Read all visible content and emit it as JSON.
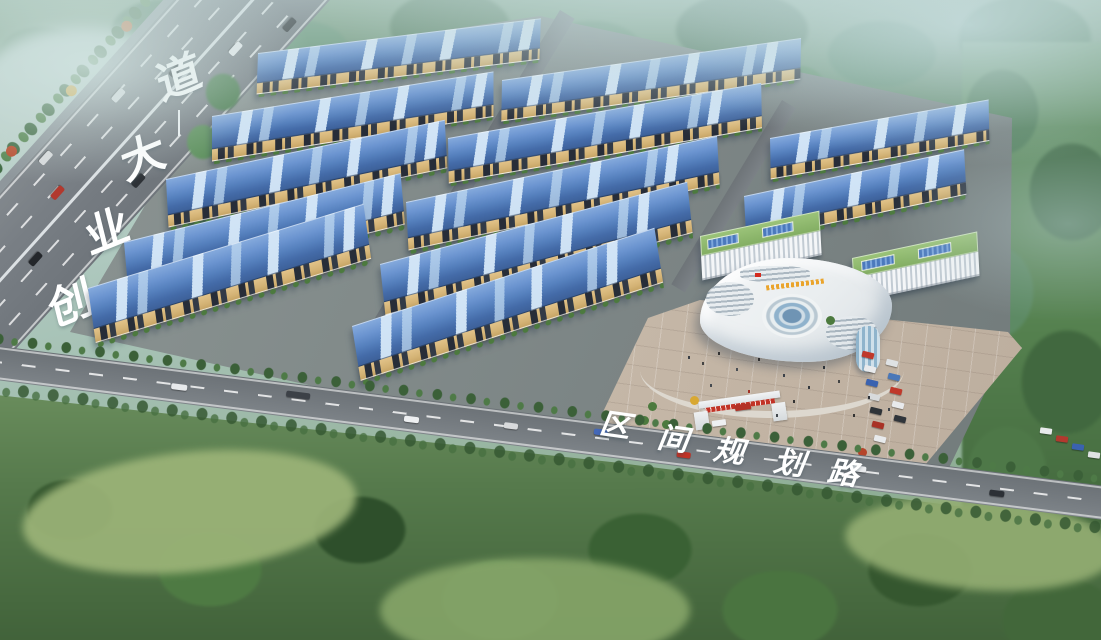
{
  "scene": {
    "description": "Hazy daytime aerial architectural rendering of an industrial park: twelve blue-roofed warehouses in three columns, a curved white headquarters with circular glass atrium and plaza, a tree-lined avenue at the upper left and a planning road across the bottom, all surrounded by misty forest."
  },
  "roads": {
    "avenue": {
      "name": "创业大道",
      "chars": [
        "创",
        "业",
        "大",
        "道"
      ]
    },
    "planning_road": {
      "name": "区间规划路",
      "chars": [
        "区",
        "间",
        "规",
        "划",
        "路"
      ]
    }
  },
  "park": {
    "warehouse_count": 12,
    "warehouse_columns": [
      5,
      5,
      2
    ],
    "roof_color": "#5580bd",
    "skylight_color": "#cde2f5",
    "wall_color": "#d3b274",
    "window_color": "#2a303a"
  },
  "campus": {
    "hq": {
      "style": "curved white office building with circular glass atrium",
      "sign_color": "#eaa42c",
      "flag_color": "#d42b1f"
    },
    "wing_buildings": {
      "count": 2,
      "roof": "green roof garden",
      "panel_color": "#4b79bd"
    },
    "gate_banner_color": "#c23326",
    "plaza_color": "#c7b9a9"
  },
  "environment": {
    "forest_color": "#4e7a52",
    "mist_color": "#cfe0dd",
    "lawn_color": "#9cb478",
    "asphalt_color": "#757b80"
  }
}
